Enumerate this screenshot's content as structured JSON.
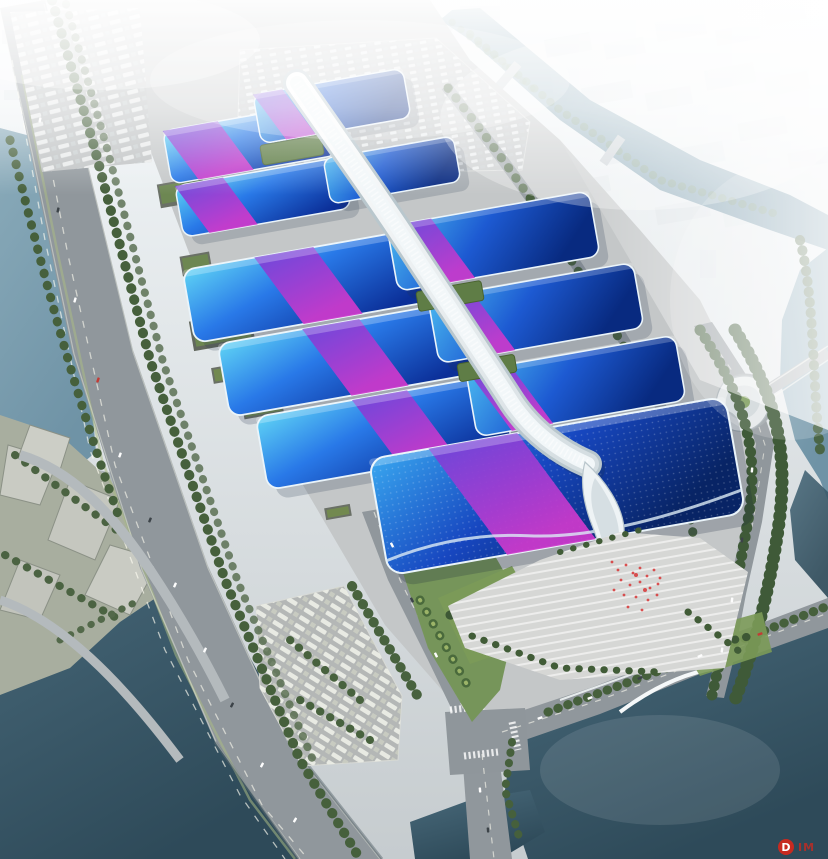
{
  "scene": {
    "kind": "aerial-architectural-rendering",
    "subject": "exhibition-convention-center-complex"
  },
  "palette": {
    "sky_top": "#f4f8fa",
    "ground": "#c4c7c8",
    "city": "#d6dee3",
    "road": "#90979c",
    "water": "#6f93a6",
    "water_deep": "#2e4a59",
    "roof_cyan": "#5fd4f5",
    "roof_blue": "#2979e8",
    "roof_deep": "#0b2f98",
    "roof_blue_mid": "#1d5ad2",
    "roof_deep2": "#082a80",
    "ribbon_violet": "#7440d8",
    "ribbon_magenta": "#cf39cc",
    "spine_white": "#f2f7f9",
    "tree_dark": "#46603c",
    "tree_light": "#7d9757",
    "lawn": "#76955a",
    "flag_red": "#d84040",
    "watermark_red": "#d0281e"
  },
  "watermark": {
    "logo_letter": "D",
    "text": "IM"
  }
}
